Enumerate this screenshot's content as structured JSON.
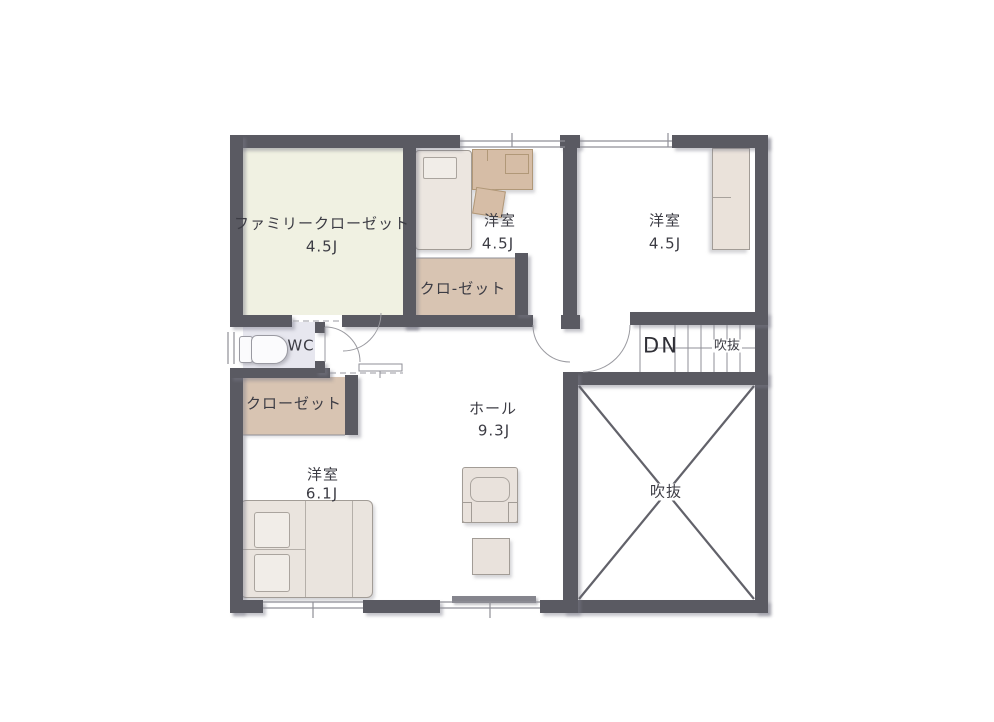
{
  "plan": {
    "title": "2F floor plan",
    "rooms": {
      "family_closet": {
        "name": "ファミリークローゼット",
        "size": "4.5J"
      },
      "bedroom_top_middle": {
        "name": "洋室",
        "size": "4.5J"
      },
      "bedroom_top_right": {
        "name": "洋室",
        "size": "4.5J"
      },
      "bedroom_bottom_left": {
        "name": "洋室",
        "size": "6.1J"
      },
      "hall": {
        "name": "ホール",
        "size": "9.3J"
      },
      "wc": {
        "name": "WC"
      },
      "closet_top": {
        "name": "クロ-ゼット"
      },
      "closet_left": {
        "name": "クローゼット"
      },
      "stairs": {
        "label": "DN",
        "void_label": "吹抜"
      },
      "void": {
        "name": "吹抜"
      }
    },
    "colors": {
      "wall": "#5a5a62",
      "family_closet_floor": "#f0f1e2",
      "closet_floor": "#d8c4b2",
      "wc_floor": "#e7e7ef",
      "furniture": "#ebe4de",
      "desk": "#d6bda6",
      "line": "#8f8f97",
      "text": "#3c3c44"
    }
  }
}
